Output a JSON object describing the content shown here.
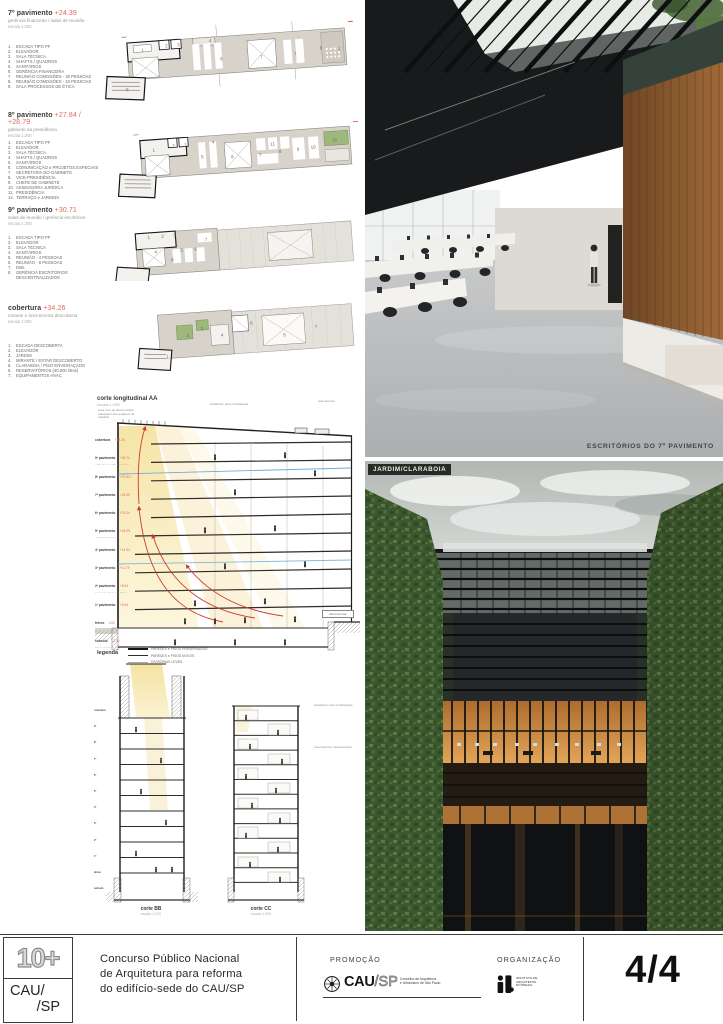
{
  "plans": [
    {
      "title": "7º pavimento",
      "elevation": "+24.39",
      "subtitle": "gerência financeira / salas de reunião",
      "scale": "escala 1:250",
      "items": [
        "ESCADA TIPO PF",
        "ELEVADOR",
        "SALA TÉCNICA",
        "SHAFTS / QUADROS",
        "SANITÁRIOS",
        "GERÊNCIA FINANCEIRA",
        "REUNIÃO COMISSÕES - 30 PESSOAS",
        "REUNIÃO COMISSÕES - 10 PESSOAS",
        "SALA PROCESSOS DE ÉTICA"
      ],
      "room_numbers": [
        {
          "n": "1",
          "x": 44,
          "y": 40
        },
        {
          "n": "2",
          "x": 68,
          "y": 37
        },
        {
          "n": "3",
          "x": 80,
          "y": 37
        },
        {
          "n": "4",
          "x": 112,
          "y": 35
        },
        {
          "n": "5",
          "x": 26,
          "y": 78
        },
        {
          "n": "6",
          "x": 122,
          "y": 54
        },
        {
          "n": "7",
          "x": 162,
          "y": 55
        },
        {
          "n": "7",
          "x": 196,
          "y": 54
        },
        {
          "n": "8",
          "x": 222,
          "y": 50
        },
        {
          "n": "9",
          "x": 240,
          "y": 52
        }
      ]
    },
    {
      "title": "8º pavimento",
      "elevation": "+27.84 / +28.79",
      "subtitle": "gabinete da presidência",
      "scale": "escala 1:250",
      "items": [
        "ESCADA TIPO PF",
        "ELEVADOR",
        "SALA TÉCNICA",
        "SHAFTS / QUADROS",
        "SANITÁRIOS",
        "COMUNICAÇÃO e PROJETOS ESPECIAIS",
        "SECRETARIA DO GABINETE",
        "VICE-PRESIDÊNCIA",
        "CHEFE DE GABINETE",
        "ASSESSORIA JURÍDICA",
        "PRESIDÊNCIA",
        "TERRAÇO e JARDINS"
      ],
      "room_numbers": [
        {
          "n": "1",
          "x": 40,
          "y": 38
        },
        {
          "n": "2",
          "x": 60,
          "y": 35
        },
        {
          "n": "3",
          "x": 72,
          "y": 35
        },
        {
          "n": "4",
          "x": 100,
          "y": 34
        },
        {
          "n": "5",
          "x": 88,
          "y": 48
        },
        {
          "n": "6",
          "x": 118,
          "y": 50
        },
        {
          "n": "7",
          "x": 146,
          "y": 50
        },
        {
          "n": "8",
          "x": 166,
          "y": 48
        },
        {
          "n": "9",
          "x": 184,
          "y": 47
        },
        {
          "n": "10",
          "x": 198,
          "y": 46
        },
        {
          "n": "11",
          "x": 158,
          "y": 40
        },
        {
          "n": "12",
          "x": 220,
          "y": 40
        }
      ]
    },
    {
      "title": "9º pavimento",
      "elevation": "+30.71",
      "subtitle": "salas de reunião / gerência escritórios",
      "scale": "escala 1:250",
      "items": [
        "ESCADA TIPO PF",
        "ELEVADOR",
        "SALA TÉCNICA",
        "SANITÁRIOS",
        "REUNIÃO - 4 PESSOAS",
        "REUNIÃO - 8 PESSOAS",
        "DML",
        "GERÊNCIA ESCRITÓRIOS DESCENTRALIZADOS"
      ],
      "room_numbers": [
        {
          "n": "1",
          "x": 40,
          "y": 30
        },
        {
          "n": "2",
          "x": 54,
          "y": 30
        },
        {
          "n": "3",
          "x": 66,
          "y": 30
        },
        {
          "n": "4",
          "x": 46,
          "y": 45
        },
        {
          "n": "5",
          "x": 72,
          "y": 45
        },
        {
          "n": "6",
          "x": 86,
          "y": 45
        },
        {
          "n": "7",
          "x": 97,
          "y": 36
        },
        {
          "n": "8",
          "x": 62,
          "y": 54
        }
      ]
    },
    {
      "title": "cobertura",
      "elevation": "+34.26",
      "subtitle": "mirante e área técnica descoberta",
      "scale": "escala 1:250",
      "items": [
        "ESCADA DESCOBERTA",
        "ELEVADOR",
        "JARDIM",
        "MIRANTE / ESTAR DESCOBERTO",
        "CLARABOIA / PISO ENVIDRAÇADO",
        "RESERVATÓRIOS (30.000 litros)",
        "EQUIPAMENTOS HVAC"
      ],
      "room_numbers": [
        {
          "n": "1",
          "x": 32,
          "y": 72
        },
        {
          "n": "2",
          "x": 54,
          "y": 52
        },
        {
          "n": "3",
          "x": 68,
          "y": 46
        },
        {
          "n": "4",
          "x": 88,
          "y": 54
        },
        {
          "n": "5",
          "x": 150,
          "y": 58
        },
        {
          "n": "6",
          "x": 118,
          "y": 44
        },
        {
          "n": "7",
          "x": 182,
          "y": 52
        }
      ]
    }
  ],
  "section_aa": {
    "title": "corte longitudinal AA",
    "scale": "escala 1:250",
    "annotations": [
      "área com pé direito amplo adequado aos espaços de trabalho",
      "claraboia / piso envidraçado",
      "área técnica"
    ],
    "street_label": "Rua Formosa",
    "floors": [
      {
        "name": "cobertura",
        "elev": "+34.26",
        "desc": "mirante e área técnica descoberta"
      },
      {
        "name": "9º pavimento",
        "elev": "+30.71",
        "desc": "salas de reunião / gerência escritórios"
      },
      {
        "name": "8º pavimento",
        "elev": "+27.84 / +28.79",
        "desc": "gabinete da presidência"
      },
      {
        "name": "7º pavimento",
        "elev": "+24.39",
        "desc": "gerência financeira / salas de reunião"
      },
      {
        "name": "6º pavimento",
        "elev": "+21.24",
        "desc": "gerências administrativas"
      },
      {
        "name": "5º pavimento",
        "elev": "+18.09",
        "desc": "gerências técnicas"
      },
      {
        "name": "4º pavimento",
        "elev": "+14.94",
        "desc": "atendimento e fiscalização"
      },
      {
        "name": "3º pavimento",
        "elev": "+11.79",
        "desc": "plenário"
      },
      {
        "name": "2º pavimento",
        "elev": "+8.64",
        "desc": "áreas de apoio / multiuso"
      },
      {
        "name": "1º pavimento",
        "elev": "+5.49",
        "desc": "sistema de informação da arquitetura e urbanismo"
      },
      {
        "name": "térreo",
        "elev": "0.00",
        "desc": "espaço compartilhado de trabalho"
      },
      {
        "name": "subsolo",
        "elev": "-3.30",
        "desc": "áreas técnicas / apoio / manutenção"
      }
    ]
  },
  "legend": {
    "title": "legenda",
    "items": [
      {
        "label": "PAREDES e PISOS PRESERVADOS"
      },
      {
        "label": "PAREDES e PISOS NOVOS"
      },
      {
        "label": "DIVISÓRIAS LEVES"
      }
    ]
  },
  "cross_sections": {
    "bb": {
      "title": "corte BB",
      "scale": "escala 1:250"
    },
    "cc": {
      "title": "corte CC",
      "scale": "escala 1:250"
    },
    "notes": [
      "claraboia / piso envidraçado",
      "reservatórios / área técnica"
    ]
  },
  "photos": {
    "caption_top": "ESCRITÓRIOS DO 7º PAVIMENTO",
    "label_bottom": "JARDIM/CLARABOIA"
  },
  "footer": {
    "logo_10plus": "10+",
    "cau_line1": "CAU/",
    "cau_line2": "/SP",
    "title_line1": "Concurso Público Nacional",
    "title_line2": "de Arquitetura para reforma",
    "title_line3": "do edifício-sede do CAU/SP",
    "promo_label": "PROMOÇÃO",
    "promo_cau": "CAU",
    "promo_sp": "/SP",
    "promo_desc1": "Conselho de Arquitetura",
    "promo_desc2": "e Urbanismo de São Paulo",
    "org_label": "ORGANIZAÇÃO",
    "org_line1": "INSTITUTO DE",
    "org_line2": "ARQUITETOS",
    "org_line3": "DO BRASIL",
    "page_number": "4/4"
  },
  "colors": {
    "accent_red": "#e0685c",
    "section_yellow": "#f5e4a6",
    "flow_red": "#cd3a2b",
    "flow_blue": "#6aaed7"
  }
}
